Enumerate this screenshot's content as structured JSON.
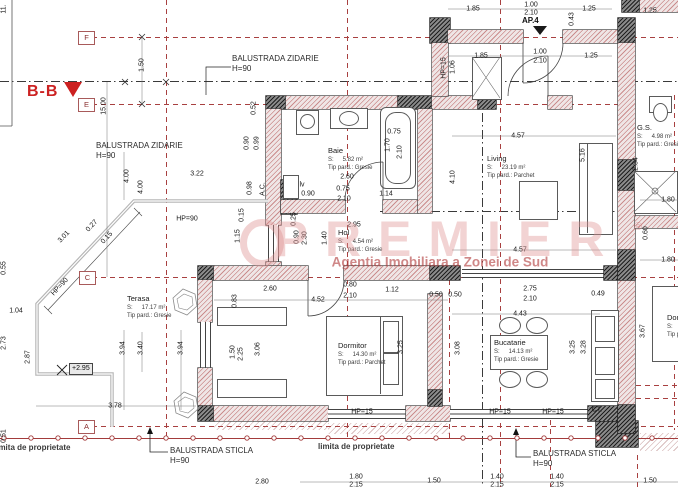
{
  "section_marker": {
    "label": "B-B"
  },
  "entrance": {
    "label": "AP.4"
  },
  "elevation_marker": {
    "text": "+2.95"
  },
  "room_area_prefix": "S:",
  "grid_markers": [
    {
      "label": "F",
      "x": 78,
      "y": 31
    },
    {
      "label": "E",
      "x": 78,
      "y": 98
    },
    {
      "label": "C",
      "x": 79,
      "y": 271
    },
    {
      "label": "A",
      "x": 78,
      "y": 420
    }
  ],
  "rooms": [
    {
      "name": "Baie",
      "area_value": "5.82 m²",
      "floor": "Tip pard.: Gresie",
      "x": 328,
      "y": 146
    },
    {
      "name": "Living",
      "area_value": "23.19 m²",
      "floor": "Tip pard.: Parchet",
      "x": 487,
      "y": 154
    },
    {
      "name": "Hol",
      "area_value": "4.54 m²",
      "floor": "Tip pard.: Gresie",
      "x": 338,
      "y": 228
    },
    {
      "name": "Terasa",
      "area_value": "17.17 m²",
      "floor": "Tip pard.: Gresie",
      "x": 127,
      "y": 294
    },
    {
      "name": "Dormitor",
      "area_value": "14.30 m²",
      "floor": "Tip pard.: Parchet",
      "x": 338,
      "y": 341
    },
    {
      "name": "Bucatarie",
      "area_value": "14.13 m²",
      "floor": "Tip pard.: Gresie",
      "x": 494,
      "y": 338
    },
    {
      "name": "G.S.",
      "area_value": "4.98 m²",
      "floor": "Tip pard.: Gresie",
      "x": 637,
      "y": 123
    },
    {
      "name": "Dormitor",
      "area_value": "",
      "floor": "Tip pard.:",
      "x": 667,
      "y": 313
    }
  ],
  "annotations": [
    {
      "text": "BALUSTRADA ZIDARIE",
      "sub": "H=90",
      "x": 232,
      "y": 54
    },
    {
      "text": "BALUSTRADA ZIDARIE",
      "sub": "H=90",
      "x": 96,
      "y": 141
    },
    {
      "text": "BALUSTRADA STICLA",
      "sub": "H=90",
      "x": 170,
      "y": 446
    },
    {
      "text": "BALUSTRADA STICLA",
      "sub": "H=90",
      "x": 533,
      "y": 449
    }
  ],
  "boundary_labels": [
    {
      "text": "limita de proprietate",
      "x": -6,
      "y": 443
    },
    {
      "text": "limita de proprietate",
      "x": 318,
      "y": 442
    }
  ],
  "watermark": {
    "brand": "PREMIER",
    "reg": "®",
    "tagline": "Agentia Imobiliara a Zonei de Sud"
  },
  "dimensions": [
    {
      "t": "1.85",
      "x": 473,
      "y": 9,
      "r": 0
    },
    {
      "t": "1.00",
      "x": 531,
      "y": 5,
      "r": 0
    },
    {
      "t": "2.10",
      "x": 531,
      "y": 13,
      "r": 0
    },
    {
      "t": "1.25",
      "x": 589,
      "y": 9,
      "r": 0
    },
    {
      "t": "1.25",
      "x": 650,
      "y": 11,
      "r": 0
    },
    {
      "t": "1.85",
      "x": 481,
      "y": 56,
      "r": 0
    },
    {
      "t": "1.00",
      "x": 540,
      "y": 52,
      "r": 0
    },
    {
      "t": "2.10",
      "x": 540,
      "y": 61,
      "r": 0
    },
    {
      "t": "1.25",
      "x": 591,
      "y": 56,
      "r": 0
    },
    {
      "t": "3.22",
      "x": 197,
      "y": 174,
      "r": 0
    },
    {
      "t": "HP=90",
      "x": 187,
      "y": 219,
      "r": 0
    },
    {
      "t": "2.60",
      "x": 347,
      "y": 177,
      "r": 0
    },
    {
      "t": "0.75",
      "x": 394,
      "y": 132,
      "r": 0
    },
    {
      "t": "0.75",
      "x": 343,
      "y": 189,
      "r": 0
    },
    {
      "t": "2.10",
      "x": 344,
      "y": 199,
      "r": 0
    },
    {
      "t": "1.14",
      "x": 386,
      "y": 194,
      "r": 0
    },
    {
      "t": "2.95",
      "x": 354,
      "y": 225,
      "r": 0
    },
    {
      "t": "lv",
      "x": 302,
      "y": 185,
      "r": 0
    },
    {
      "t": "0.90",
      "x": 308,
      "y": 194,
      "r": 0
    },
    {
      "t": "2.60",
      "x": 270,
      "y": 289,
      "r": 0
    },
    {
      "t": "0.80",
      "x": 350,
      "y": 285,
      "r": 0
    },
    {
      "t": "2.10",
      "x": 350,
      "y": 296,
      "r": 0
    },
    {
      "t": "4.52",
      "x": 318,
      "y": 300,
      "r": 0
    },
    {
      "t": "1.12",
      "x": 392,
      "y": 290,
      "r": 0
    },
    {
      "t": "0.50",
      "x": 436,
      "y": 295,
      "r": 0
    },
    {
      "t": "0.50",
      "x": 455,
      "y": 295,
      "r": 0
    },
    {
      "t": "2.75",
      "x": 530,
      "y": 289,
      "r": 0
    },
    {
      "t": "2.10",
      "x": 530,
      "y": 299,
      "r": 0
    },
    {
      "t": "0.49",
      "x": 598,
      "y": 294,
      "r": 0
    },
    {
      "t": "4.43",
      "x": 520,
      "y": 314,
      "r": 0
    },
    {
      "t": "4.57",
      "x": 518,
      "y": 136,
      "r": 0
    },
    {
      "t": "4.57",
      "x": 520,
      "y": 250,
      "r": 0
    },
    {
      "t": "1.04",
      "x": 16,
      "y": 311,
      "r": 0
    },
    {
      "t": "3.78",
      "x": 115,
      "y": 406,
      "r": 0
    },
    {
      "t": "1.80",
      "x": 668,
      "y": 200,
      "r": 0
    },
    {
      "t": "1.80",
      "x": 668,
      "y": 260,
      "r": 0
    },
    {
      "t": "HP=15",
      "x": 362,
      "y": 412,
      "r": 0
    },
    {
      "t": "HP=15",
      "x": 500,
      "y": 412,
      "r": 0
    },
    {
      "t": "HP=15",
      "x": 553,
      "y": 412,
      "r": 0
    },
    {
      "t": "CT.",
      "x": 597,
      "y": 410,
      "r": 0
    },
    {
      "t": "2.80",
      "x": 262,
      "y": 482,
      "r": 0
    },
    {
      "t": "1.80",
      "x": 356,
      "y": 477,
      "r": 0
    },
    {
      "t": "2.15",
      "x": 356,
      "y": 485,
      "r": 0
    },
    {
      "t": "1.50",
      "x": 434,
      "y": 481,
      "r": 0
    },
    {
      "t": "1.40",
      "x": 497,
      "y": 477,
      "r": 0
    },
    {
      "t": "2.15",
      "x": 497,
      "y": 485,
      "r": 0
    },
    {
      "t": "1.40",
      "x": 557,
      "y": 477,
      "r": 0
    },
    {
      "t": "2.15",
      "x": 557,
      "y": 485,
      "r": 0
    },
    {
      "t": "1.50",
      "x": 650,
      "y": 481,
      "r": 0
    },
    {
      "t": "11.",
      "x": 4,
      "y": 9,
      "r": -90
    },
    {
      "t": "1.50",
      "x": 142,
      "y": 65,
      "r": -90
    },
    {
      "t": "15.00",
      "x": 104,
      "y": 106,
      "r": -90
    },
    {
      "t": "0.52",
      "x": 254,
      "y": 108,
      "r": -90
    },
    {
      "t": "0.90",
      "x": 247,
      "y": 143,
      "r": -90
    },
    {
      "t": "0.99",
      "x": 257,
      "y": 143,
      "r": -90
    },
    {
      "t": "0.98",
      "x": 250,
      "y": 188,
      "r": -90
    },
    {
      "t": "A.C.",
      "x": 263,
      "y": 189,
      "r": -90
    },
    {
      "t": "1.70",
      "x": 388,
      "y": 145,
      "r": -90
    },
    {
      "t": "2.10",
      "x": 400,
      "y": 152,
      "r": -90
    },
    {
      "t": "0.90",
      "x": 297,
      "y": 237,
      "r": -90
    },
    {
      "t": "2.30",
      "x": 305,
      "y": 238,
      "r": -90
    },
    {
      "t": "1.40",
      "x": 325,
      "y": 238,
      "r": -90
    },
    {
      "t": "0.15",
      "x": 242,
      "y": 215,
      "r": -90
    },
    {
      "t": "1.15",
      "x": 238,
      "y": 236,
      "r": -90
    },
    {
      "t": "0.25",
      "x": 294,
      "y": 219,
      "r": -90
    },
    {
      "t": "4.00",
      "x": 127,
      "y": 176,
      "r": -90
    },
    {
      "t": "4.00",
      "x": 141,
      "y": 187,
      "r": -90
    },
    {
      "t": "0.55",
      "x": 4,
      "y": 268,
      "r": -90
    },
    {
      "t": "2.73",
      "x": 4,
      "y": 343,
      "r": -90
    },
    {
      "t": "2.87",
      "x": 28,
      "y": 357,
      "r": -90
    },
    {
      "t": "0.51",
      "x": 4,
      "y": 436,
      "r": -90
    },
    {
      "t": "3.94",
      "x": 123,
      "y": 348,
      "r": -90
    },
    {
      "t": "3.40",
      "x": 141,
      "y": 348,
      "r": -90
    },
    {
      "t": "3.94",
      "x": 181,
      "y": 348,
      "r": -90
    },
    {
      "t": "1.50",
      "x": 233,
      "y": 352,
      "r": -90
    },
    {
      "t": "2.25",
      "x": 241,
      "y": 354,
      "r": -90
    },
    {
      "t": "3.06",
      "x": 258,
      "y": 349,
      "r": -90
    },
    {
      "t": "0.83",
      "x": 235,
      "y": 301,
      "r": -90
    },
    {
      "t": "3.25",
      "x": 401,
      "y": 347,
      "r": -90
    },
    {
      "t": "3.08",
      "x": 458,
      "y": 348,
      "r": -90
    },
    {
      "t": "3.25",
      "x": 573,
      "y": 347,
      "r": -90
    },
    {
      "t": "3.28",
      "x": 584,
      "y": 347,
      "r": -90
    },
    {
      "t": "5.16",
      "x": 583,
      "y": 155,
      "r": -90
    },
    {
      "t": "4.10",
      "x": 453,
      "y": 177,
      "r": -90
    },
    {
      "t": "1.06",
      "x": 453,
      "y": 67,
      "r": -90
    },
    {
      "t": "HP=15",
      "x": 444,
      "y": 68,
      "r": -90
    },
    {
      "t": "0.43",
      "x": 572,
      "y": 19,
      "r": -90
    },
    {
      "t": "2.34",
      "x": 636,
      "y": 164,
      "r": -90
    },
    {
      "t": "0.60",
      "x": 646,
      "y": 233,
      "r": -90
    },
    {
      "t": "3.67",
      "x": 643,
      "y": 331,
      "r": -90
    },
    {
      "t": "3.01",
      "x": 64,
      "y": 237,
      "r": -47
    },
    {
      "t": "0.27",
      "x": 92,
      "y": 226,
      "r": -47
    },
    {
      "t": "0.15",
      "x": 107,
      "y": 238,
      "r": -47
    },
    {
      "t": "HP=90",
      "x": 60,
      "y": 287,
      "r": -47
    }
  ]
}
